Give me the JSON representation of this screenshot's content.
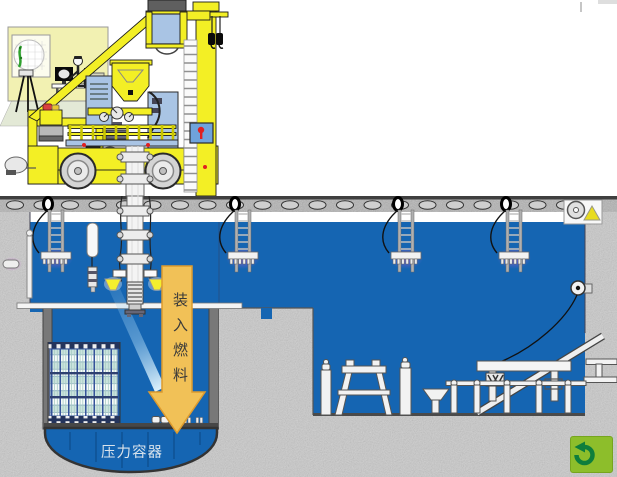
{
  "labels": {
    "arrow": "装入燃料",
    "vessel": "压力容器"
  },
  "controls": {
    "back_button": {
      "icon": "return-arrow-icon"
    }
  },
  "colors": {
    "water": "#1565B2",
    "machine_yellow": "#F3EF25",
    "control_room_wall": "#F2F1B2",
    "equipment_panel": "#A9C4E4",
    "concrete": "#C9C9C9",
    "arrow_fill": "#F1C157",
    "arrow_border": "#DE9B2D",
    "vessel_text": "#D9E3EC",
    "button_green": "#8DBE2B",
    "button_arrow_green": "#0E7E3C",
    "glow_purple": "#C050D0",
    "funnel_yellow": "#F4EF2E"
  }
}
